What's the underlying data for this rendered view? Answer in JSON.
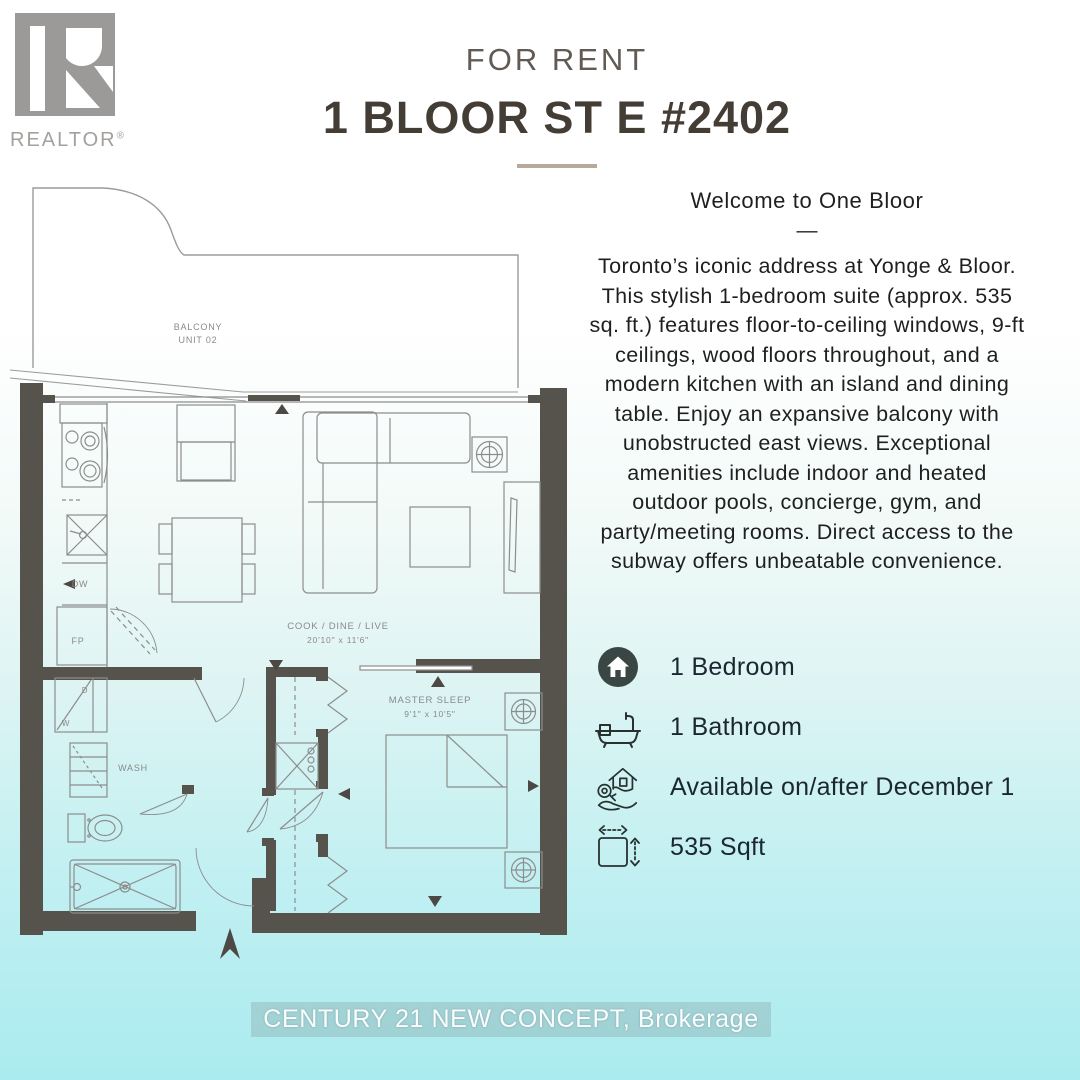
{
  "header": {
    "logo_brand": "REALTOR",
    "logo_reg": "®",
    "for_rent": "FOR RENT",
    "title": "1 BLOOR ST E #2402"
  },
  "description": {
    "heading": "Welcome to One Bloor",
    "dash": "—",
    "body": "Toronto’s iconic address at Yonge & Bloor. This stylish 1-bedroom suite (approx. 535 sq. ft.) features floor-to-ceiling windows, 9-ft ceilings, wood floors throughout, and a modern kitchen with an island and dining table. Enjoy an expansive balcony with unobstructed east views. Exceptional amenities include indoor and heated outdoor pools, concierge, gym, and party/meeting rooms. Direct access to the subway offers unbeatable convenience."
  },
  "features": [
    {
      "icon": "house-icon",
      "label": "1 Bedroom"
    },
    {
      "icon": "bathtub-icon",
      "label": "1 Bathroom"
    },
    {
      "icon": "key-handover-icon",
      "label": "Available on/after December 1"
    },
    {
      "icon": "floor-area-icon",
      "label": "535 Sqft"
    }
  ],
  "floorplan": {
    "balcony_line1": "BALCONY",
    "balcony_line2": "UNIT 02",
    "living_line1": "COOK / DINE / LIVE",
    "living_line2": "20'10\" x 11'6\"",
    "master_line1": "MASTER SLEEP",
    "master_line2": "9'1\" x 10'5\"",
    "wash": "WASH",
    "dw": "DW",
    "fp": "FP",
    "dryer": "D",
    "washer": "W"
  },
  "footer": {
    "brokerage": "CENTURY 21 NEW CONCEPT, Brokerage"
  },
  "colors": {
    "background_top": "#ffffff",
    "background_bottom": "#aaebef",
    "wall": "#56534d",
    "plan_line": "#8d8d8d",
    "divider_tan": "#b7aa99",
    "title_text": "#433d36",
    "logo_gray": "#9c9a98",
    "feature_text": "#1b2630"
  }
}
